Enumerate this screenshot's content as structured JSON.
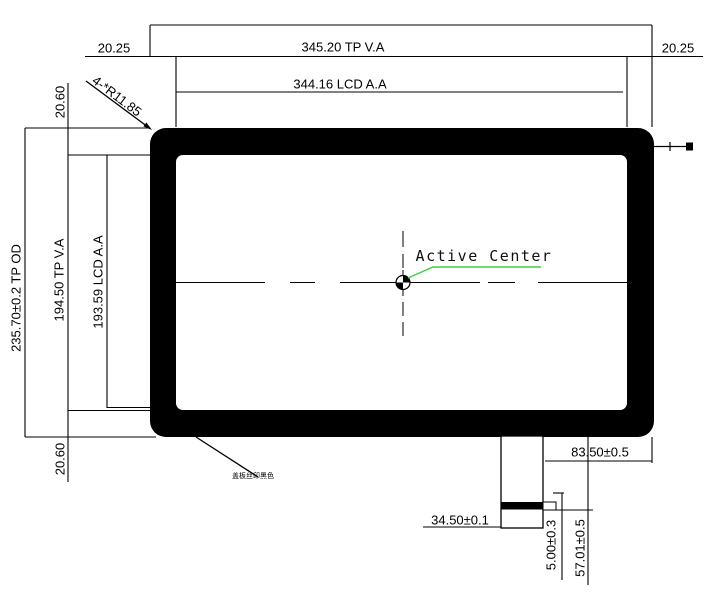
{
  "drawing": {
    "labels": {
      "top_margin_left": "20.25",
      "tp_va_width": "345.20 TP V.A",
      "top_margin_right": "20.25",
      "lcd_aa_width": "344.16 LCD A.A",
      "corner_radius": "4-*R11.85",
      "side_margin_top": "20.60",
      "tp_od_height": "235.70±0.2 TP OD",
      "tp_va_height": "194.50 TP V.A",
      "lcd_aa_height": "193.59 LCD A.A",
      "side_margin_bottom": "20.60",
      "active_center": "Active Center",
      "cover_print_note": "盖板丝印黑色",
      "fpc_right_offset": "83.50±0.5",
      "fpc_width": "34.50±0.1",
      "fpc_stiffener_thickness": "5.00±0.3",
      "fpc_length": "57.01±0.5"
    },
    "colors": {
      "line": "#000000",
      "leader": "#3fcf3f",
      "background": "#ffffff"
    }
  }
}
